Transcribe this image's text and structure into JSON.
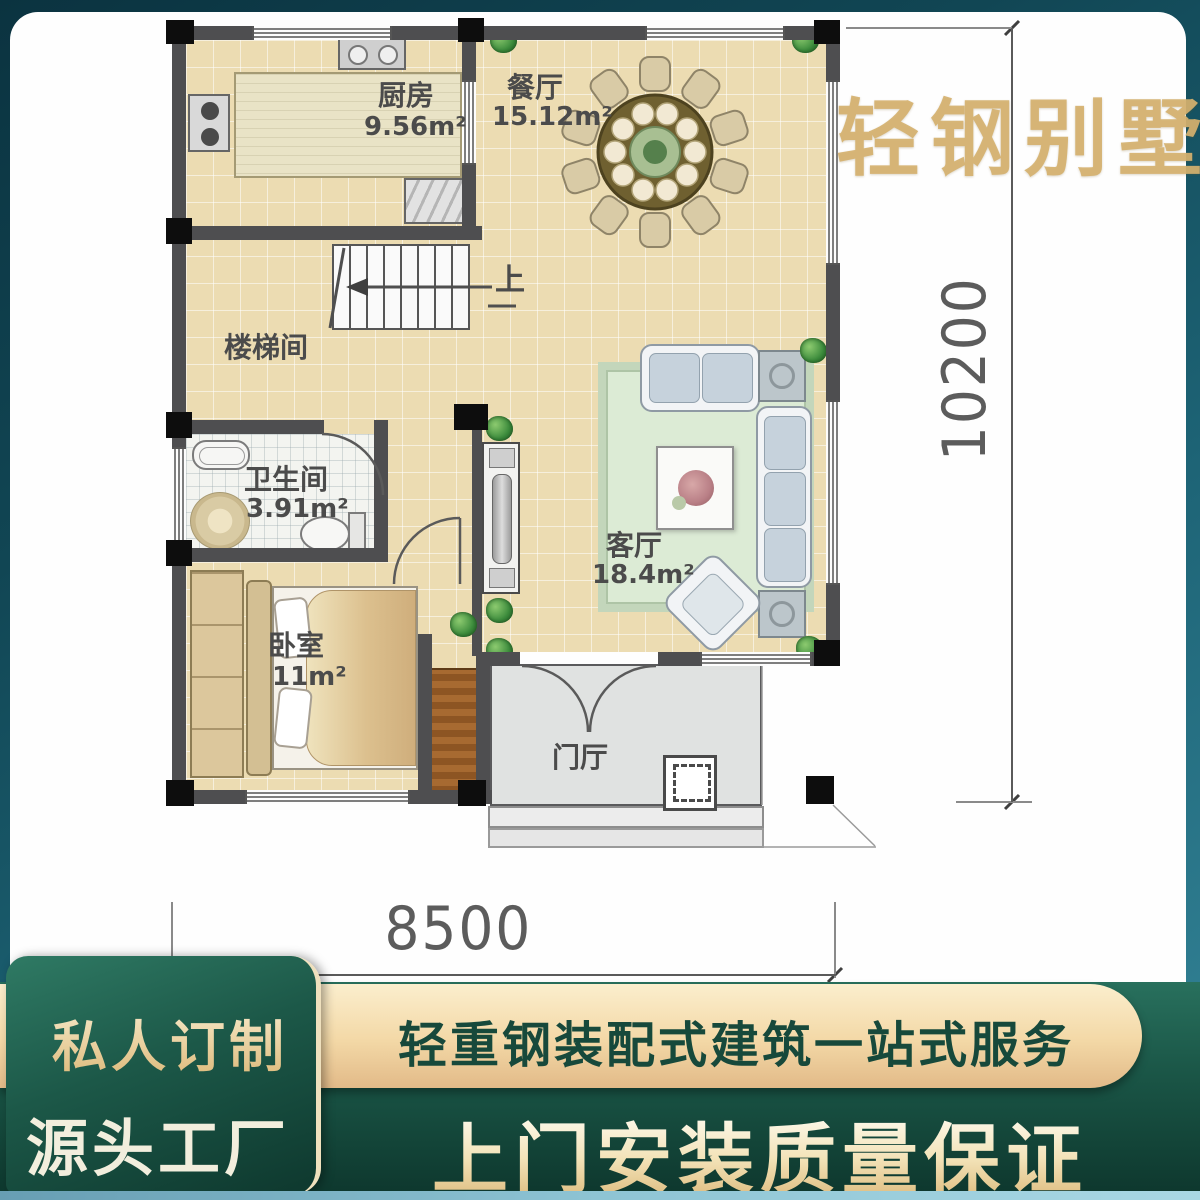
{
  "brand": {
    "title": "轻钢别墅"
  },
  "plan": {
    "rooms": {
      "kitchen": {
        "label": "厨房",
        "area": "9.56m²"
      },
      "dining": {
        "label": "餐厅",
        "area": "15.12m²"
      },
      "stairwell": {
        "label": "楼梯间",
        "area": ""
      },
      "bathroom": {
        "label": "卫生间",
        "area": "3.91m²"
      },
      "bedroom": {
        "label": "卧室",
        "area": "11m²"
      },
      "living": {
        "label": "客厅",
        "area": "18.4m²"
      },
      "foyer": {
        "label": "门厅",
        "area": ""
      }
    },
    "stairs_direction_label": "上",
    "dimensions": {
      "width": "8500",
      "height": "10200"
    }
  },
  "footer": {
    "badge_line1": "私人订制",
    "badge_line2": "源头工厂",
    "ribbon_text": "轻重钢装配式建筑一站式服务",
    "headline": "上门安装质量保证"
  },
  "colors": {
    "frame_teal": "#1d6375",
    "banner_green": "#1a5546",
    "ribbon_gold": "#f3d8a6",
    "title_gold": "#d5b16f",
    "floor_tan": "#ecdcb2",
    "wall_gray": "#4e4e50"
  }
}
